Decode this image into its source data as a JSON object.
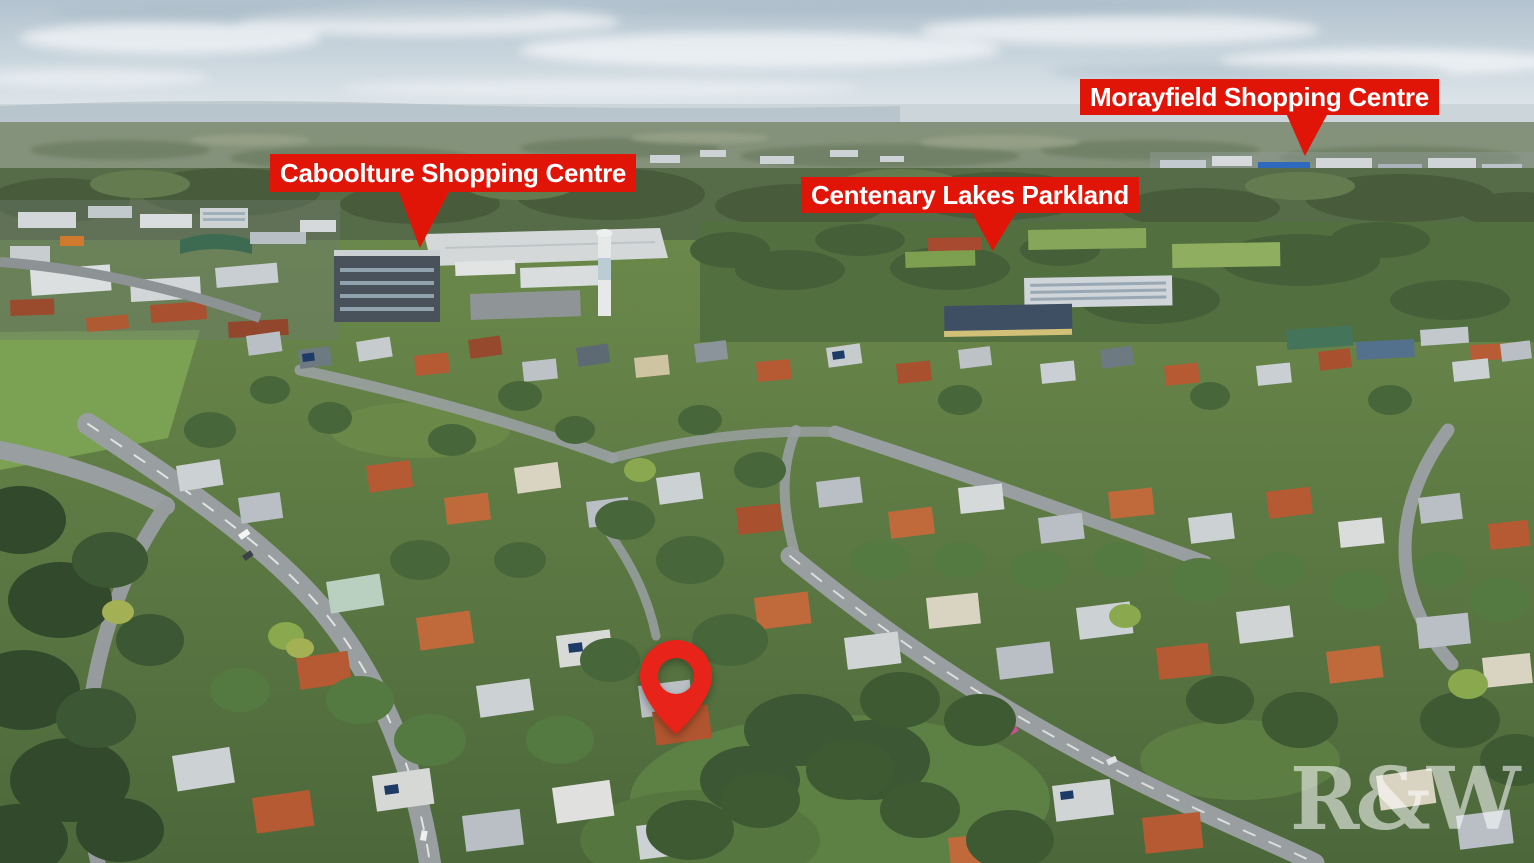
{
  "callouts": [
    {
      "id": "caboolture-shopping-centre",
      "label": "Caboolture Shopping Centre"
    },
    {
      "id": "morayfield-shopping-centre",
      "label": "Morayfield Shopping Centre"
    },
    {
      "id": "centenary-lakes-parkland",
      "label": "Centenary Lakes Parkland"
    }
  ],
  "marker": {
    "icon": "location-pin"
  },
  "watermark": {
    "text": "R&W"
  },
  "colors": {
    "callout_bg": "#e01508",
    "callout_text": "#ffffff",
    "pin": "#e8231a",
    "watermark_text": "#ffffff"
  }
}
